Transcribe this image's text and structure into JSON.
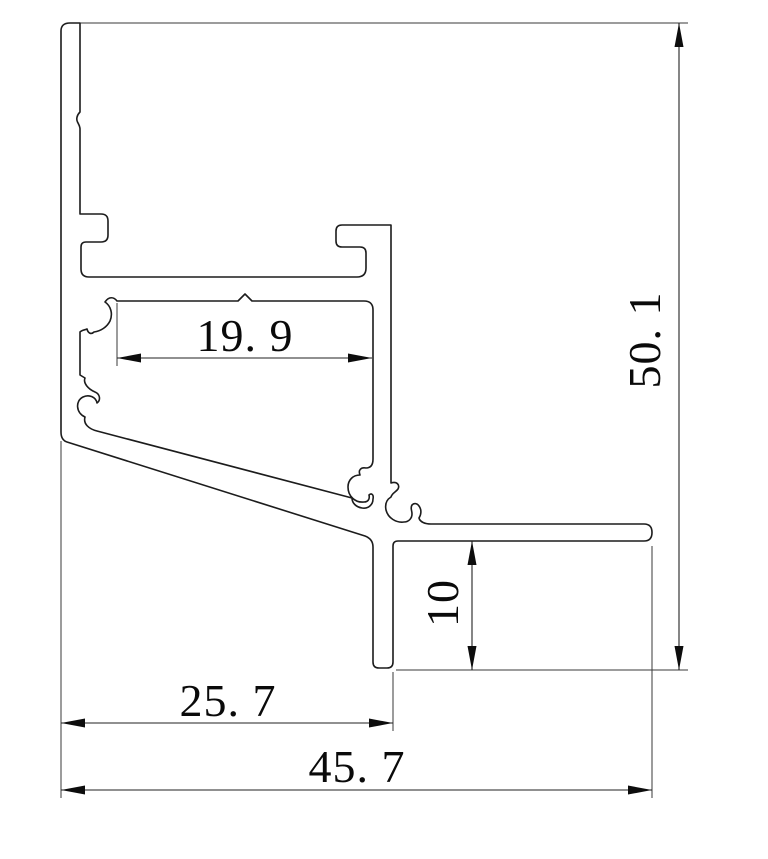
{
  "drawing": {
    "kind": "technical-cross-section",
    "subject": "aluminum-profile-section",
    "background_color": "#ffffff",
    "outline_color": "#1c1c1c",
    "dimension_color": "#0d0d0d",
    "dimensions": {
      "inner_width": {
        "label": "19. 9",
        "value": 19.9,
        "orientation": "horizontal"
      },
      "total_height": {
        "label": "50. 1",
        "value": 50.1,
        "orientation": "vertical"
      },
      "flange_drop": {
        "label": "10",
        "value": 10,
        "orientation": "vertical"
      },
      "left_width": {
        "label": "25. 7",
        "value": 25.7,
        "orientation": "horizontal"
      },
      "total_width": {
        "label": "45. 7",
        "value": 45.7,
        "orientation": "horizontal"
      }
    }
  }
}
